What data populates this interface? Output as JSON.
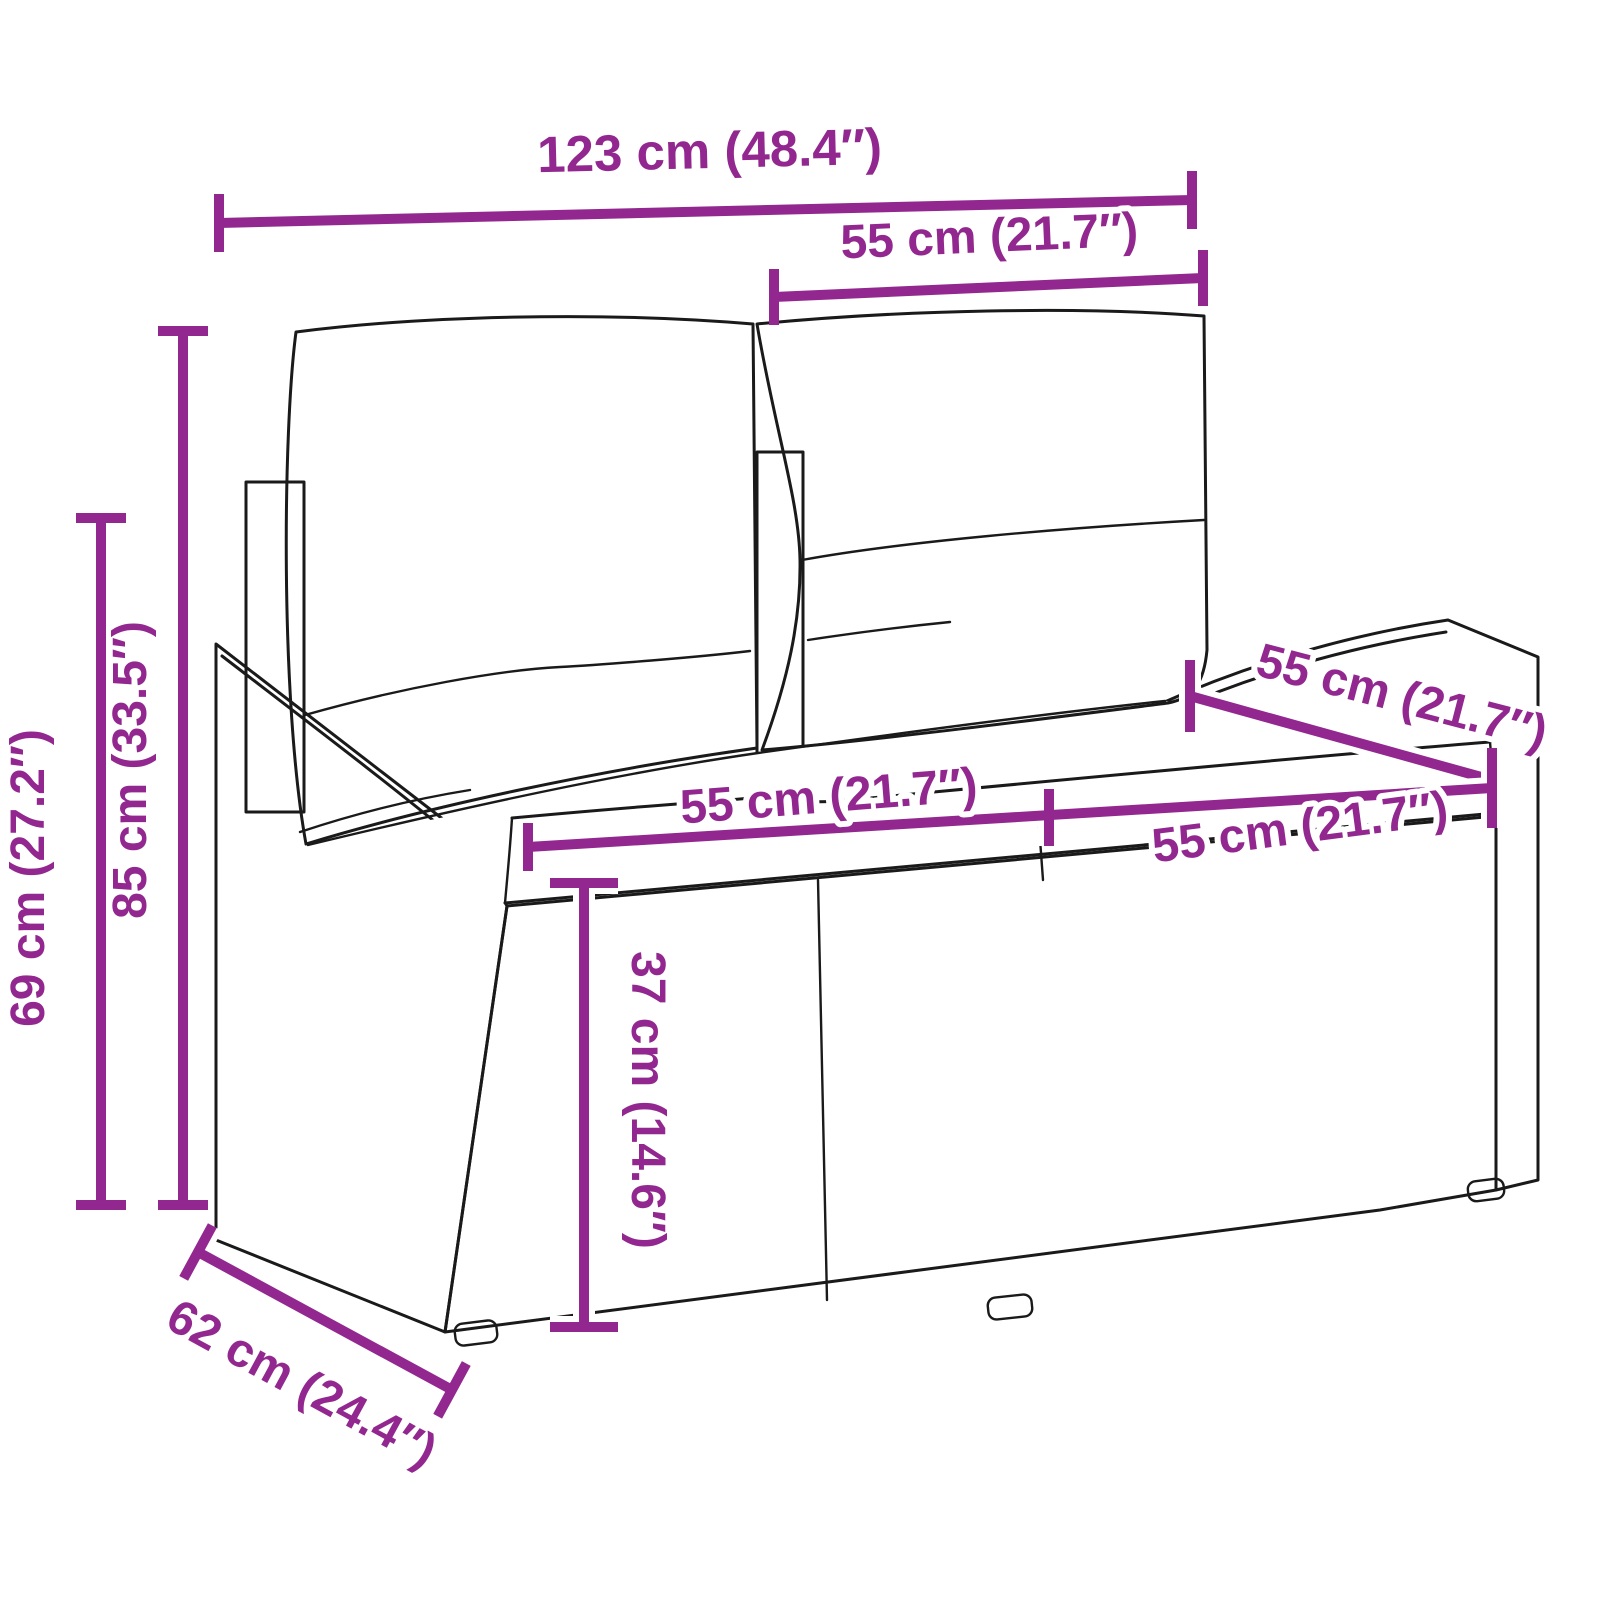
{
  "figure": {
    "type": "product-dimension-diagram",
    "subject": "rattan 2-seater garden sofa with cushions",
    "accent_color": "#92278F",
    "line_color": "#1a1a1a"
  },
  "dimensions": {
    "overall_width": {
      "label": "123 cm (48.4″)"
    },
    "backrest_width": {
      "label": "55 cm (21.7″)"
    },
    "overall_height": {
      "label": "85 cm (33.5″)"
    },
    "armrest_height": {
      "label": "69 cm (27.2″)"
    },
    "seat_depth": {
      "label": "55 cm (21.7″)"
    },
    "seat_width_left": {
      "label": "55 cm (21.7″)"
    },
    "seat_width_right": {
      "label": "55 cm (21.7″)"
    },
    "seat_height": {
      "label": "37 cm (14.6″)"
    },
    "overall_depth": {
      "label": "62 cm (24.4″)"
    }
  }
}
